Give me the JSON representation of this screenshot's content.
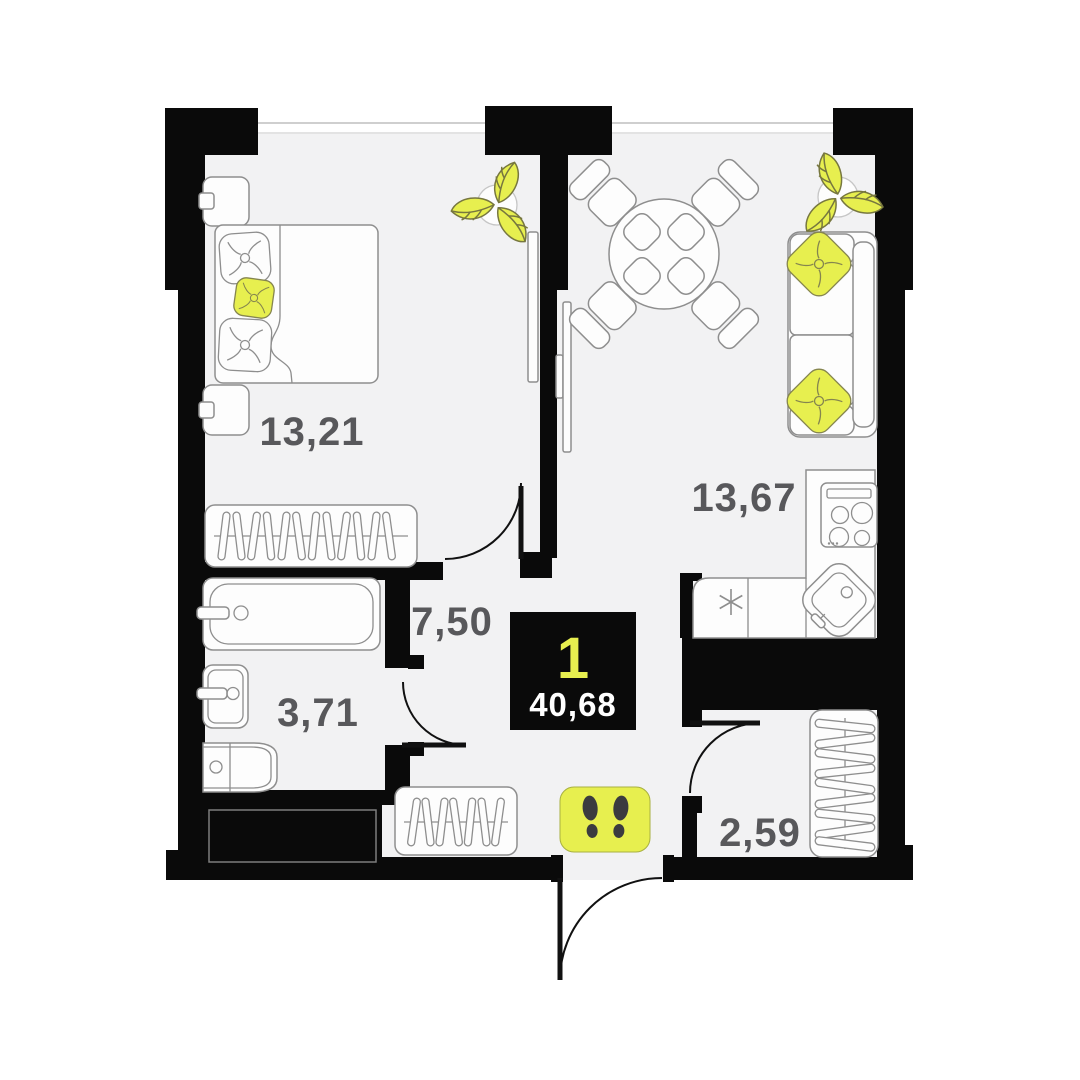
{
  "plan": {
    "badge": {
      "rooms_count": "1",
      "total_area": "40,68"
    },
    "rooms": {
      "bedroom": {
        "label": "13,21"
      },
      "living": {
        "label": "13,67"
      },
      "hallway": {
        "label": "7,50"
      },
      "bathroom": {
        "label": "3,71"
      },
      "closet": {
        "label": "2,59"
      }
    },
    "colors": {
      "wall": "#0a0a0a",
      "floor": "#f2f2f3",
      "accent": "#e7ef4f",
      "furniture_line": "#8e8e8e",
      "label_text": "#58585b",
      "badge_background": "#0a0a0a",
      "badge_rooms_text": "#e7ef4f",
      "badge_area_text": "#ffffff",
      "footprints": "#3b3b3f"
    }
  }
}
